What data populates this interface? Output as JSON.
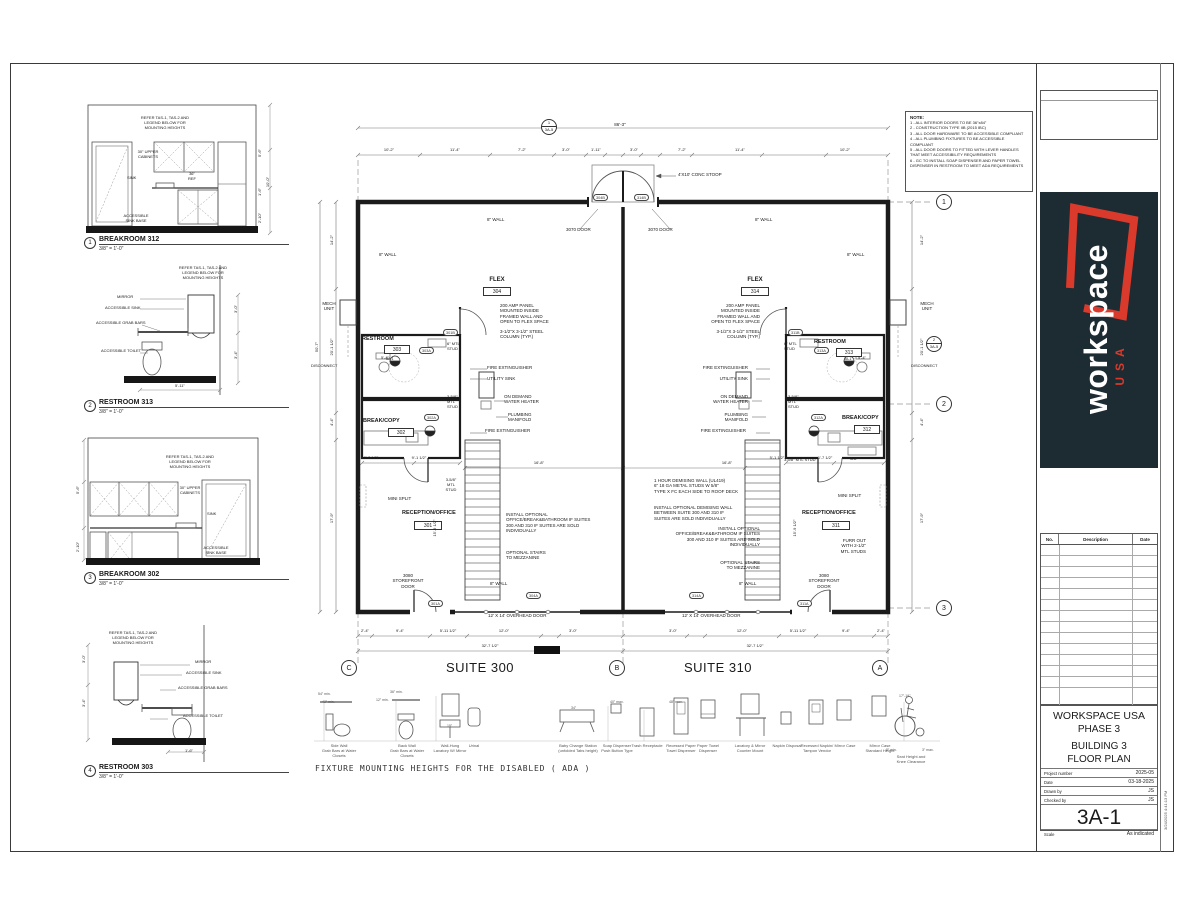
{
  "notes": {
    "title": "NOTE:",
    "lines": [
      "1 - ALL INTERIOR DOORS TO BE 36\"x84\"",
      "2 - CONSTRUCTION TYPE IIB (2015 IBC)",
      "3 - ALL DOOR HARDWARE TO BE ACCESSIBLE COMPLIANT",
      "4 - ALL PLUMBING FIXTURES TO BE ACCESSIBLE COMPLIANT",
      "5 - ALL DOOR DOORS TO FITTED WITH LEVER HANDLES THAT MEET ACCESSIBILITY REQUIREMENTS",
      "6 - GC TO INSTALL SOAP DISPENSER AND PAPER TOWEL DISPENSER IN RESTROOM TO MEET ADA REQUIREMENTS"
    ]
  },
  "details": [
    {
      "num": "1",
      "title": "BREAKROOM 312",
      "scale": "3/8\" = 1'-0\"",
      "refer": "REFER TAS-1, TAS-2 AND\nLEGEND BELOW FOR\nMOUNTING HEIGHTS",
      "cabinets": "30\" UPPER\nCABINETS",
      "sink": "SINK",
      "ref": "36\"\nREF",
      "sink_base": "ACCESSIBLE\nSINK BASE",
      "dims": [
        "5'-6\"",
        "10'-0\"",
        "1'-6\"",
        "2'-10\""
      ]
    },
    {
      "num": "2",
      "title": "RESTROOM 313",
      "scale": "3/8\" = 1'-0\"",
      "refer": "REFER TAS-1, TAS-2 AND\nLEGEND BELOW FOR\nMOUNTING HEIGHTS",
      "mirror": "MIRROR",
      "sink": "ACCESSIBLE SINK",
      "grab": "ACCESSIBLE GRAB BARS",
      "toilet": "ACCESSIBLE TOILET",
      "dims": [
        "3'-0\"",
        "3'-4\"",
        "5'-11\""
      ]
    },
    {
      "num": "3",
      "title": "BREAKROOM 302",
      "scale": "3/8\" = 1'-0\"",
      "refer": "REFER TAS-1, TAS-2 AND\nLEGEND BELOW FOR\nMOUNTING HEIGHTS",
      "cabinets": "30\" UPPER\nCABINETS",
      "sink": "SINK",
      "sink_base": "ACCESSIBLE\nSINK BASE",
      "dims": [
        "5'-6\"",
        "2'-10\""
      ]
    },
    {
      "num": "4",
      "title": "RESTROOM 303",
      "scale": "3/8\" = 1'-0\"",
      "refer": "REFER TAS-1, TAS-2 AND\nLEGEND BELOW FOR\nMOUNTING HEIGHTS",
      "mirror": "MIRROR",
      "sink": "ACCESSIBLE SINK",
      "grab": "ACCESSIBLE GRAB BARS",
      "toilet": "ACCESSIBLE TOILET",
      "dims": [
        "3'-0\"",
        "3'-4\"",
        "1'-6\""
      ]
    }
  ],
  "plan": {
    "suites": {
      "left": "SUITE 300",
      "right": "SUITE 310"
    },
    "grid": {
      "letters": [
        "C",
        "B",
        "A"
      ],
      "numbers": [
        "1",
        "2",
        "3"
      ]
    },
    "marker_3a1": "3A-1",
    "section_top": {
      "num": "1",
      "sheet": "3A-5"
    },
    "section_right": {
      "num": "2",
      "sheet": "3A-5"
    },
    "rooms": {
      "flex_left": {
        "name": "FLEX",
        "num": "304"
      },
      "flex_right": {
        "name": "FLEX",
        "num": "314"
      },
      "restroom_left": {
        "name": "RESTROOM",
        "num": "303"
      },
      "restroom_right": {
        "name": "RESTROOM",
        "num": "313"
      },
      "break_left": {
        "name": "BREAK/COPY",
        "num": "302"
      },
      "break_right": {
        "name": "BREAK/COPY",
        "num": "312"
      },
      "reception_left": {
        "name": "RECEPTION/OFFICE",
        "num": "301"
      },
      "reception_right": {
        "name": "RECEPTION/OFFICE",
        "num": "311"
      }
    },
    "annotations": {
      "amp_panel": "200 AMP PANEL\nMOUNTED INSIDE\nFRAMED WALL AND\nOPEN TO FLEX SPACE",
      "steel_column": "3-1/2\"X 3-1/2\" STEEL\nCOLUMN (TYP.)",
      "fire_ext": "FIRE EXTINGUISHER",
      "utility_sink": "UTILITY SINK",
      "water_heater": "ON DEMAND\nWATER HEATER",
      "plumbing": "PLUMBING\nMANIFOLD",
      "mini_split": "MINI SPLIT",
      "mtl6": "6\" MTL\nSTUD",
      "mtl358": "3-5/8\"\nMTL\nSTUD",
      "mtl358_inline": "3-5/8\" MTL STUD",
      "furr_out": "FURR OUT\nWITH 2-1/2\"\nMTL STUDS",
      "storefront": "3080\nSTOREFRONT\nDOOR",
      "demising": "1 HOUR DEMISING WALL (UL419)\n6\" 18 GA METAL STUDS W 5/8\"\nTYPE X FC EACH SIDE TO ROOF DECK",
      "optional_demising": "INSTALL OPTIONAL DEMISING WALL\nBETWEEN SUITE 300 AND 310 IF\nSUITES ARE SOLD INDIVIDUALLY",
      "optional_office": "INSTALL OPTIONAL\nOFFICE/BREAK&BATHROOM IF SUITES\n300 AND 310 IF SUITES ARE SOLD\nINDIVIDUALLY",
      "optional_stairs": "OPTIONAL STAIRS\nTO MEZZANINE",
      "overhead_door": "12' X 14' OVERHEAD DOOR",
      "door3070": "3070 DOOR",
      "conc_stoop": "4'X10' CONC STOOP",
      "wall8": "8\" WALL",
      "mech_unit": "MECH\nUNIT",
      "disconnect": "DISCONNECT",
      "uc": "UC"
    },
    "door_tags": {
      "d304B": "304B",
      "d314B": "314B",
      "d301B": "301B",
      "d311B": "311B",
      "d303A": "303A",
      "d313A": "313A",
      "d302A": "302A",
      "d312A": "312A",
      "d304A": "304A",
      "d314A": "314A",
      "d301A": "301A",
      "d311A": "311A"
    },
    "dims": {
      "overall_top": "86'-3\"",
      "top": [
        "10'-2\"",
        "11'-4\"",
        "7'-2\"",
        "3'-0\"",
        "1'-11\"",
        "3'-0\"",
        "7'-2\"",
        "11'-4\"",
        "10'-2\""
      ],
      "bottom": [
        "2'-4\"",
        "9'-4\"",
        "5'-11 1/2\"",
        "12'-0\"",
        "3'-0\"",
        "3'-0\"",
        "12'-0\"",
        "5'-11 1/2\"",
        "9'-4\"",
        "2'-4\""
      ],
      "bottom_totals": [
        "32'-7 1/2\"",
        "32'-7 1/2\""
      ],
      "left": [
        "14'-2\"",
        "20'-1 1/2\"",
        "4'-4\"",
        "17'-9\""
      ],
      "left_overall": "50'-7\"",
      "right": [
        "14'-2\"",
        "20'-1 1/2\"",
        "4'-4\"",
        "17'-9\""
      ],
      "interior": {
        "suite_l": "16'-8\"",
        "suite_r": "16'-8\"",
        "rec_l1": "8'-7 1/2\"",
        "rec_l2": "9'-1 1/2\"",
        "rec_r1": "5'-1 1/2\"",
        "rec_r2": "6'-7 1/2\"",
        "rec_h_l": "15'-9 1/2\"",
        "rec_h_r": "15'-9 1/2\"",
        "rr_l": "5'-4\"",
        "rr_r": "5'-4\""
      }
    }
  },
  "ada": {
    "caption": "FIXTURE MOUNTING HEIGHTS FOR THE DISABLED ( ADA )",
    "fixtures": [
      "Side Wall\nGrab Bars at Water Closets",
      "Back Wall\nGrab Bars at Water Closets",
      "Wall-Hung\nLavatory W/ Mirror",
      "Urinal",
      "Baby Change Station\n(unfolded Tabs height)",
      "Soap Dispenser\nPush Button Type",
      "Trash Receptacle",
      "Recessed Paper\nTowel Dispenser",
      "Paper Towel\nDispenser",
      "Lavatory & Mirror\nCounter Mount",
      "Napkin Disposal",
      "Recessed Napkin/\nTampon Vendor",
      "Mirror Case",
      "Mirror Case\nStandard Height",
      "Seat Height and\nKnee Clearance"
    ],
    "dims": [
      "54\" min.",
      "42\" min.",
      "36\" min.",
      "12\" min.",
      "40\" max.",
      "34\"",
      "15\"",
      "48\" max.",
      "17\"-19\"",
      "8\" min.",
      "3\" max."
    ]
  },
  "titleblock": {
    "company": "WORKSPACE USA",
    "phase": "PHASE 3",
    "sheet_title": "BUILDING 3\nFLOOR PLAN",
    "fields": [
      {
        "label": "Project number",
        "value": "2025-05"
      },
      {
        "label": "Date",
        "value": "03-18-2025"
      },
      {
        "label": "Drawn by",
        "value": "JS"
      },
      {
        "label": "Checked by",
        "value": "JS"
      }
    ],
    "sheet_number": "3A-1",
    "scale_label": "Scale",
    "scale_value": "As indicated",
    "rev_headers": [
      "No.",
      "Description",
      "Date"
    ],
    "timestamp": "3/24/2025 4:41:13 PM",
    "logo": {
      "text": "workspace",
      "sub": "USA",
      "bg": "#1d2b33",
      "accent": "#d93a2b"
    }
  }
}
